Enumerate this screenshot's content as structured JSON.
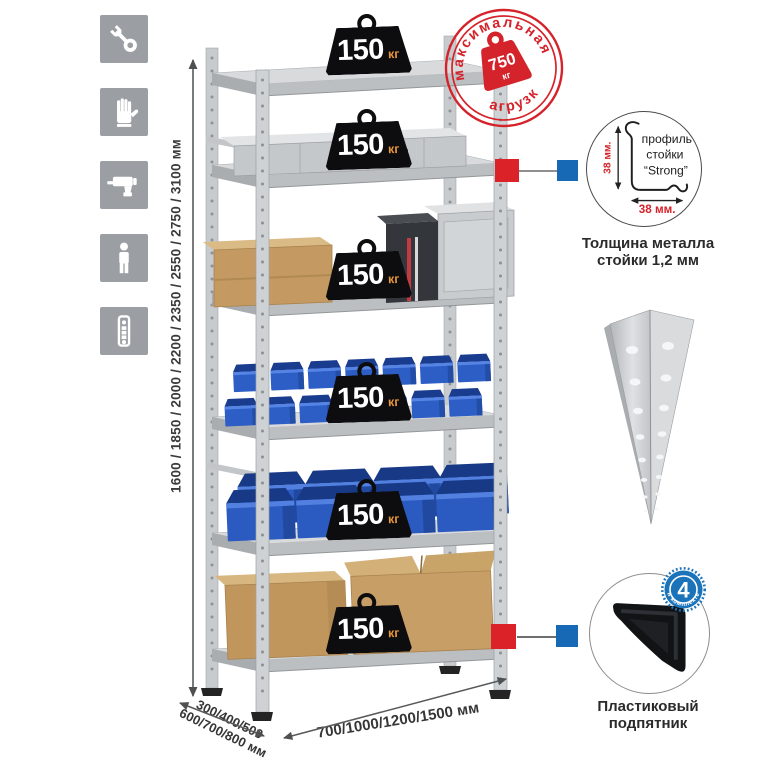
{
  "sidebar": {
    "icons": [
      {
        "name": "wrench-icon"
      },
      {
        "name": "gloves-icon"
      },
      {
        "name": "drill-icon"
      },
      {
        "name": "person-icon"
      },
      {
        "name": "rack-post-icon"
      }
    ]
  },
  "dimensions": {
    "height_label": "1600 / 1850 / 2000 / 2200 / 2350 / 2550 / 2750 / 3100 мм",
    "depth_line1": "300/400/500",
    "depth_line2": "600/700/800 мм",
    "width_label": "700/1000/1200/1500 мм"
  },
  "rack": {
    "shelf_loads": [
      {
        "value": "150",
        "unit": "кг"
      },
      {
        "value": "150",
        "unit": "кг"
      },
      {
        "value": "150",
        "unit": "кг"
      },
      {
        "value": "150",
        "unit": "кг"
      },
      {
        "value": "150",
        "unit": "кг"
      },
      {
        "value": "150",
        "unit": "кг"
      }
    ]
  },
  "max_load_stamp": {
    "arc_top": "максимальная",
    "arc_bottom": "нагрузка",
    "value": "750",
    "unit": "кг"
  },
  "profile_detail": {
    "line1": "профиль",
    "line2": "стойки",
    "line3": "“Strong”",
    "dim_vertical": "38 мм.",
    "dim_horizontal": "38 мм.",
    "caption1": "Толщина металла",
    "caption2": "стойки 1,2 мм"
  },
  "foot_detail": {
    "badge_value": "4",
    "badge_arc": "в комплекте",
    "caption1": "Пластиковый",
    "caption2": "подпятник"
  },
  "colors": {
    "stamp_red": "#d5232b",
    "marker_red": "#da2228",
    "marker_blue": "#1769b5",
    "bin_blue": "#2d5ec6",
    "unit_orange": "#e8963c",
    "icon_gray": "#9b9fa3"
  }
}
